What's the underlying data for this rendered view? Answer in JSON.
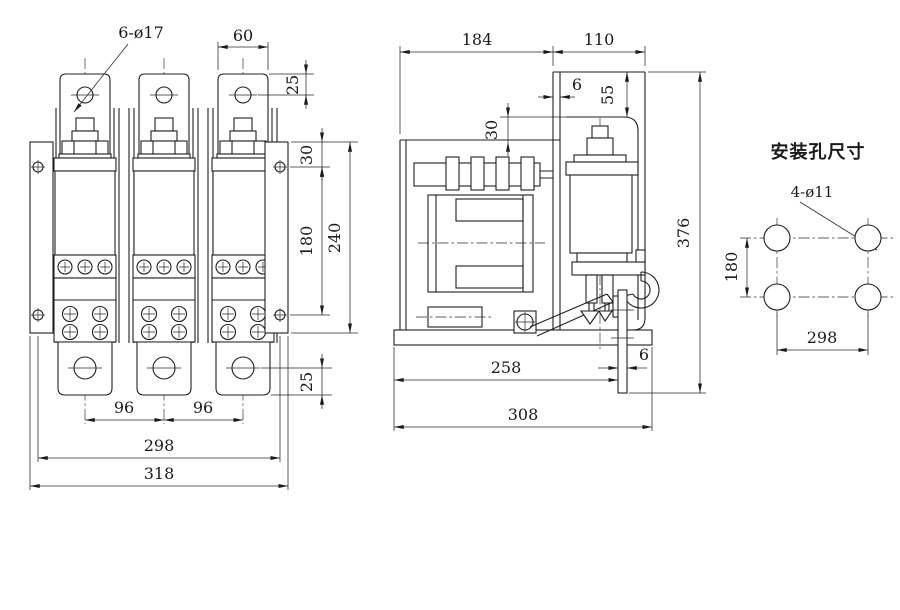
{
  "front_view": {
    "callout_hole": "6-ø17",
    "dim_tab_width": "60",
    "dim_tab_hole_offset": "25",
    "dim_bracket_hole_top": "30",
    "dim_bracket_hole_span": "180",
    "dim_bracket_height": "240",
    "dim_bottom_hole_offset": "25",
    "dim_pole_pitch_1": "96",
    "dim_pole_pitch_2": "96",
    "dim_mount_span": "298",
    "dim_overall_width": "318"
  },
  "side_view": {
    "dim_depth_front": "184",
    "dim_depth_rear": "110",
    "dim_web_thickness": "6",
    "dim_top_offset": "55",
    "dim_gap": "30",
    "dim_overall_height": "376",
    "dim_base_front": "258",
    "dim_plate_thickness": "6",
    "dim_base_depth": "308"
  },
  "mounting_view": {
    "title": "安装孔尺寸",
    "callout_hole": "4-ø11",
    "dim_vertical": "180",
    "dim_horizontal": "298"
  },
  "colors": {
    "line": "#1f1f1f",
    "background": "#ffffff"
  }
}
